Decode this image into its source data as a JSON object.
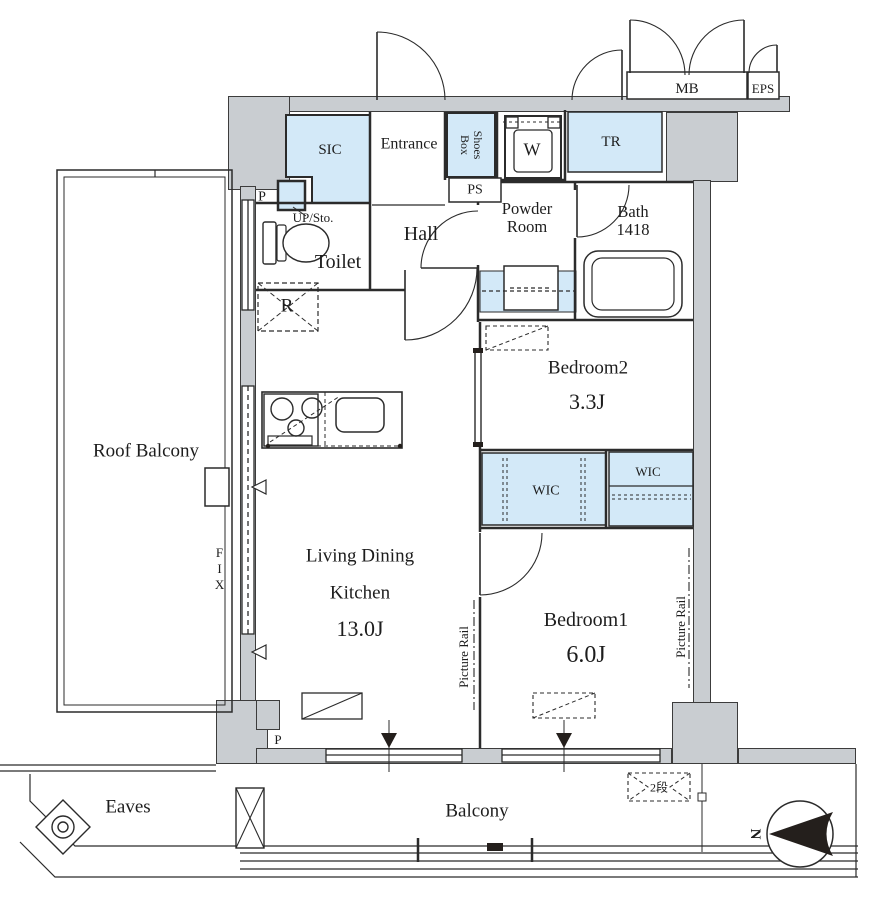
{
  "colors": {
    "wall_fill": "#c9cdd1",
    "storage_fill": "#d3e9f8",
    "line": "#2b2b2b"
  },
  "rooms": {
    "mb": "MB",
    "eps": "EPS",
    "sic": "SIC",
    "entrance": "Entrance",
    "shoes_line1": "Shoes",
    "shoes_line2": "Box",
    "washer": "W",
    "ps": "PS",
    "tr": "TR",
    "powder_line1": "Powder",
    "powder_line2": "Room",
    "bath_line1": "Bath",
    "bath_line2": "1418",
    "toilet": "Toilet",
    "hall": "Hall",
    "up_sto": "UP/Sto.",
    "pillar_top": "P",
    "pillar_bottom": "P",
    "fridge": "R",
    "ldk_line1": "Living Dining",
    "ldk_line2": "Kitchen",
    "ldk_size": "13.0J",
    "bedroom2": "Bedroom2",
    "bedroom2_size": "3.3J",
    "wic_left": "WIC",
    "wic_right": "WIC",
    "bedroom1": "Bedroom1",
    "bedroom1_size": "6.0J",
    "roof_balcony": "Roof Balcony",
    "fix": "FIX",
    "picture_rail_left": "Picture Rail",
    "picture_rail_right": "Picture Rail",
    "eaves": "Eaves",
    "balcony": "Balcony",
    "step_note": "2段"
  },
  "compass": {
    "north_label": "N"
  }
}
